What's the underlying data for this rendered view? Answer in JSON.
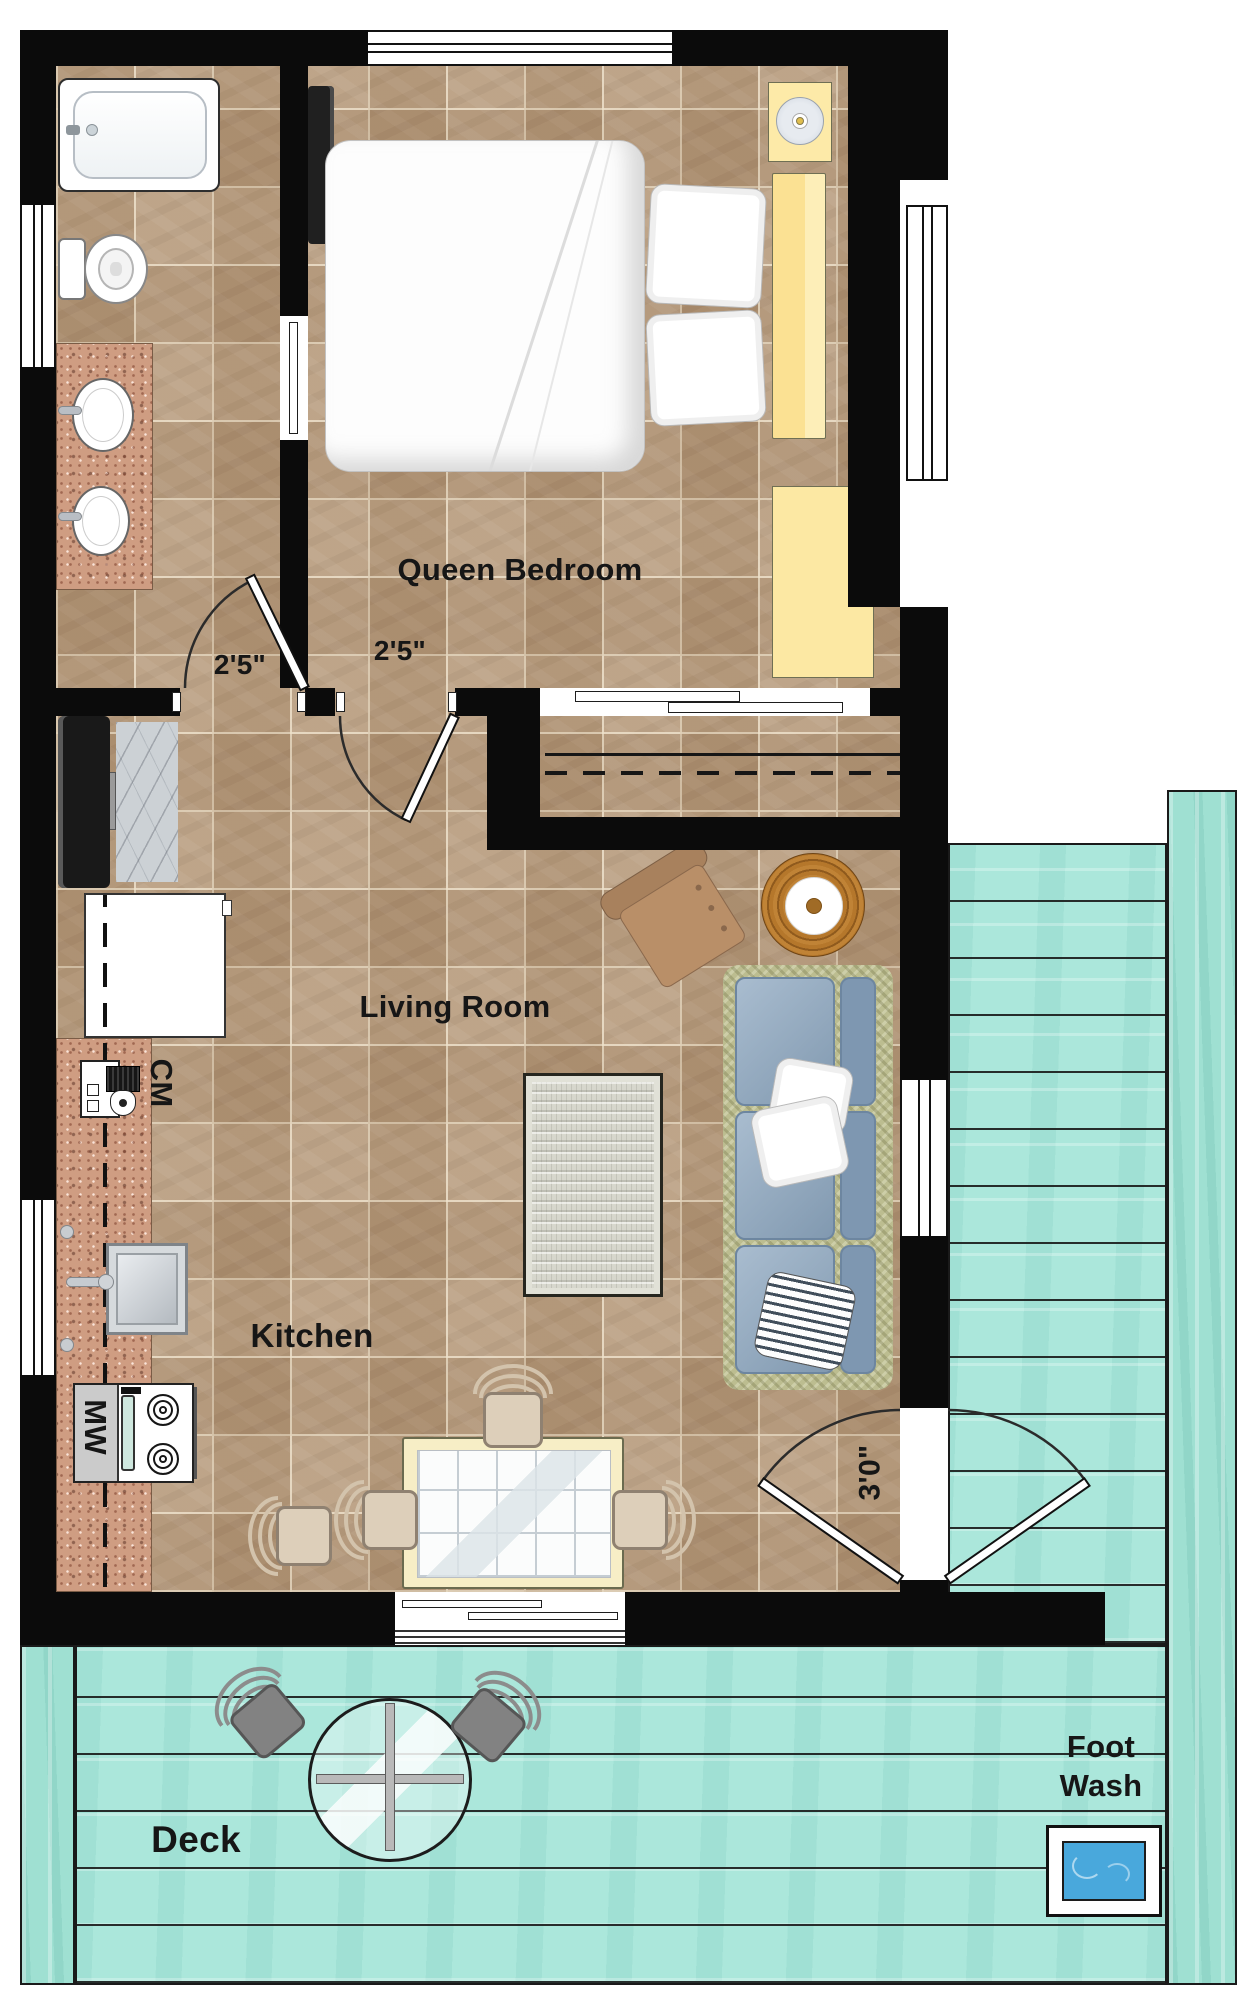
{
  "rooms": [
    {
      "id": "queen-bedroom",
      "label": "Queen Bedroom"
    },
    {
      "id": "living-room",
      "label": "Living Room"
    },
    {
      "id": "kitchen",
      "label": "Kitchen"
    },
    {
      "id": "deck",
      "label": "Deck"
    },
    {
      "id": "foot-wash",
      "label": "Foot Wash"
    }
  ],
  "door_dimensions": [
    {
      "id": "bathroom-door",
      "label": "2'5\""
    },
    {
      "id": "bedroom-door",
      "label": "2'5\""
    },
    {
      "id": "entry-door",
      "label": "3'0\""
    }
  ],
  "appliances": [
    {
      "id": "coffee-maker",
      "label": "CM"
    },
    {
      "id": "microwave",
      "label": "MW"
    }
  ],
  "colors": {
    "wall": "#0b0b0b",
    "tile_floor": "#b69a7b",
    "tile_grout": "#ebddc4",
    "deck_teal": "#abe7db",
    "deck_border_plank": "#9fe0d2",
    "granite_counter": "#cf9d82",
    "furniture_yellow": "#fce8a3",
    "sofa_blue": "#8ca6bf",
    "armchair_brown": "#b98f68",
    "rug_gray": "#d7d7cd",
    "wicker_table": "#b5772b",
    "foot_wash_water": "#49a8dc"
  }
}
